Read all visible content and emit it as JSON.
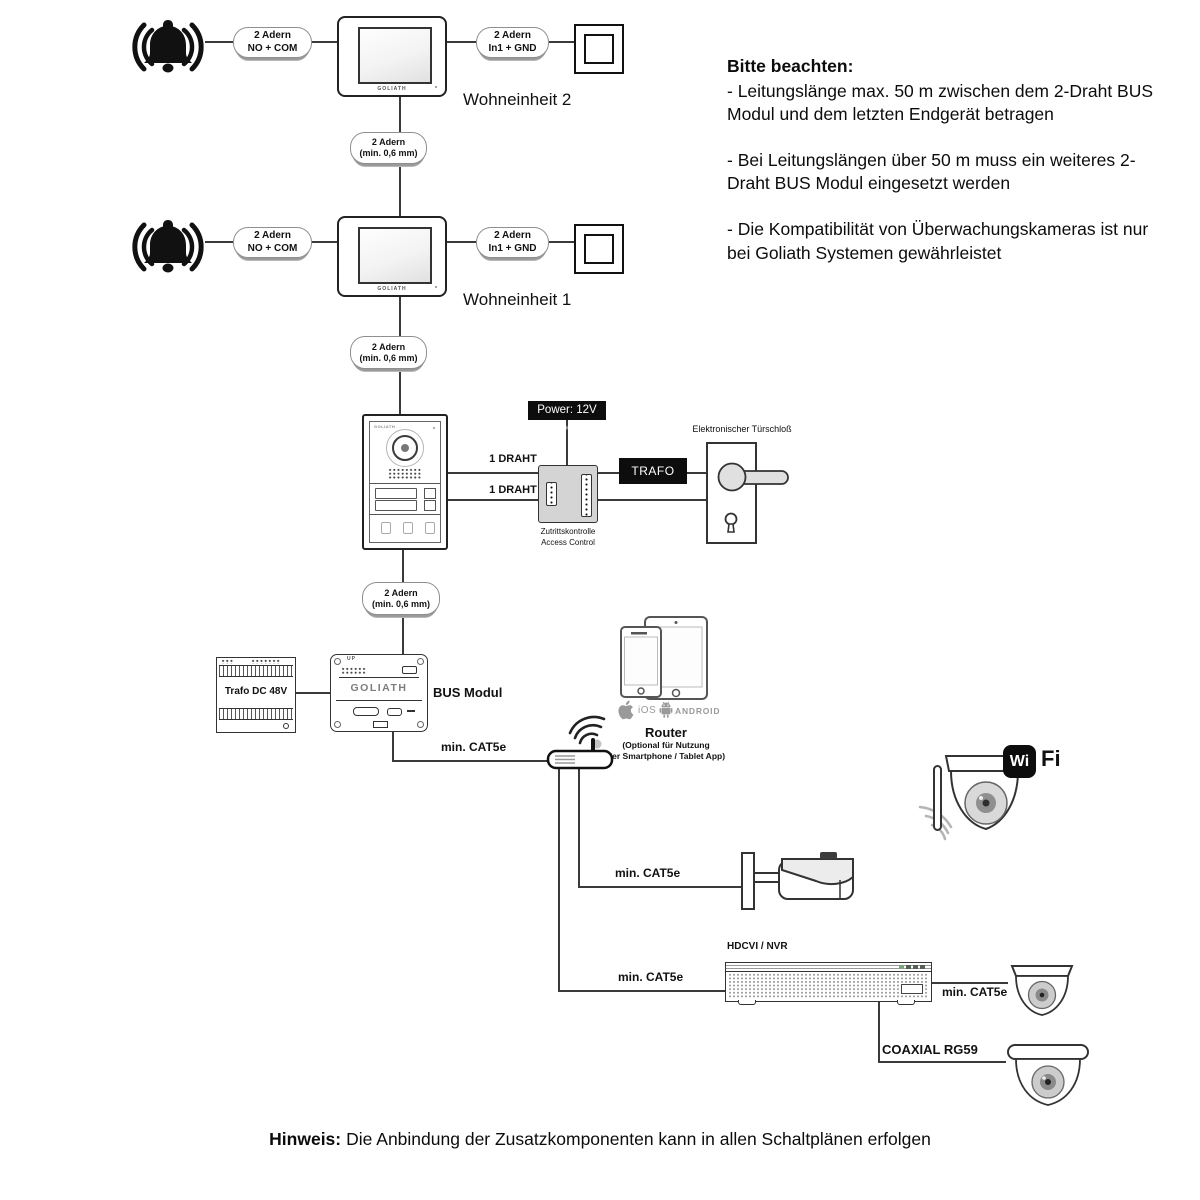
{
  "units": [
    {
      "label": "Wohneinheit 2"
    },
    {
      "label": "Wohneinheit 1"
    }
  ],
  "connectors": {
    "no_com": {
      "line1": "2 Adern",
      "line2": "NO + COM"
    },
    "in1_gnd": {
      "line1": "2 Adern",
      "line2": "In1 + GND"
    },
    "min06": {
      "line1": "2 Adern",
      "line2": "(min. 0,6 mm)"
    }
  },
  "door_station": {
    "wire_label": "1 DRAHT"
  },
  "access_control": {
    "power_label": "Power: 12V DC",
    "trafo_label": "TRAFO",
    "caption_line1": "Zutrittskontrolle",
    "caption_line2": "Access Control"
  },
  "door_lock": {
    "label": "Elektronischer Türschloß"
  },
  "bus": {
    "label": "BUS Modul",
    "brand": "GOLIATH",
    "up": "UP",
    "trafo_label": "Trafo DC 48V"
  },
  "network": {
    "cat5e": "min. CAT5e",
    "coaxial": "COAXIAL RG59",
    "nvr_label": "HDCVI / NVR",
    "router": {
      "title": "Router",
      "subtitle_line1": "(Optional für Nutzung",
      "subtitle_line2": "der Smartphone / Tablet App)"
    },
    "platforms": {
      "ios": "iOS",
      "android": "ANDROID"
    },
    "wifi": {
      "wi": "Wi",
      "fi": "Fi"
    }
  },
  "notes": {
    "title": "Bitte beachten:",
    "items": [
      "- Leitungslänge max. 50 m zwischen dem 2-Draht BUS Modul und dem letzten Endgerät betragen",
      "- Bei Leitungslängen über 50 m muss ein weiteres 2-Draht BUS Modul eingesetzt werden",
      "- Die Kompatibilität von Überwachungskameras ist nur bei Goliath Systemen gewährleistet"
    ]
  },
  "footer": {
    "label": "Hinweis:",
    "text": "Die Anbindung der Zusatzkomponenten kann in allen Schaltplänen erfolgen"
  },
  "colors": {
    "wire": "#3a3a3a",
    "box_border": "#222222",
    "black_fill": "#0d0d0d",
    "module_gray": "#d4d4d4",
    "icon_gray": "#9a9a9a",
    "wave_gray": "#b5b5b5"
  },
  "icons": {
    "bell-icon": "ringing bell",
    "wall-button-icon": "square push button",
    "monitor-icon": "indoor monitor",
    "door-station-icon": "outdoor door station",
    "access-control-icon": "access control module",
    "door-lock-icon": "electronic door lock",
    "din-transformer-icon": "DIN rail transformer",
    "bus-module-icon": "2-wire BUS module",
    "router-icon": "wifi router",
    "smartphone-icon": "smartphone",
    "tablet-icon": "tablet",
    "apple-icon": "apple logo",
    "android-icon": "android robot",
    "wifi-logo-icon": "WiFi badge",
    "wifi-dome-camera-icon": "wifi dome camera",
    "bullet-camera-icon": "bullet camera",
    "nvr-icon": "HDCVI/NVR recorder",
    "dome-camera-icon": "dome camera"
  }
}
